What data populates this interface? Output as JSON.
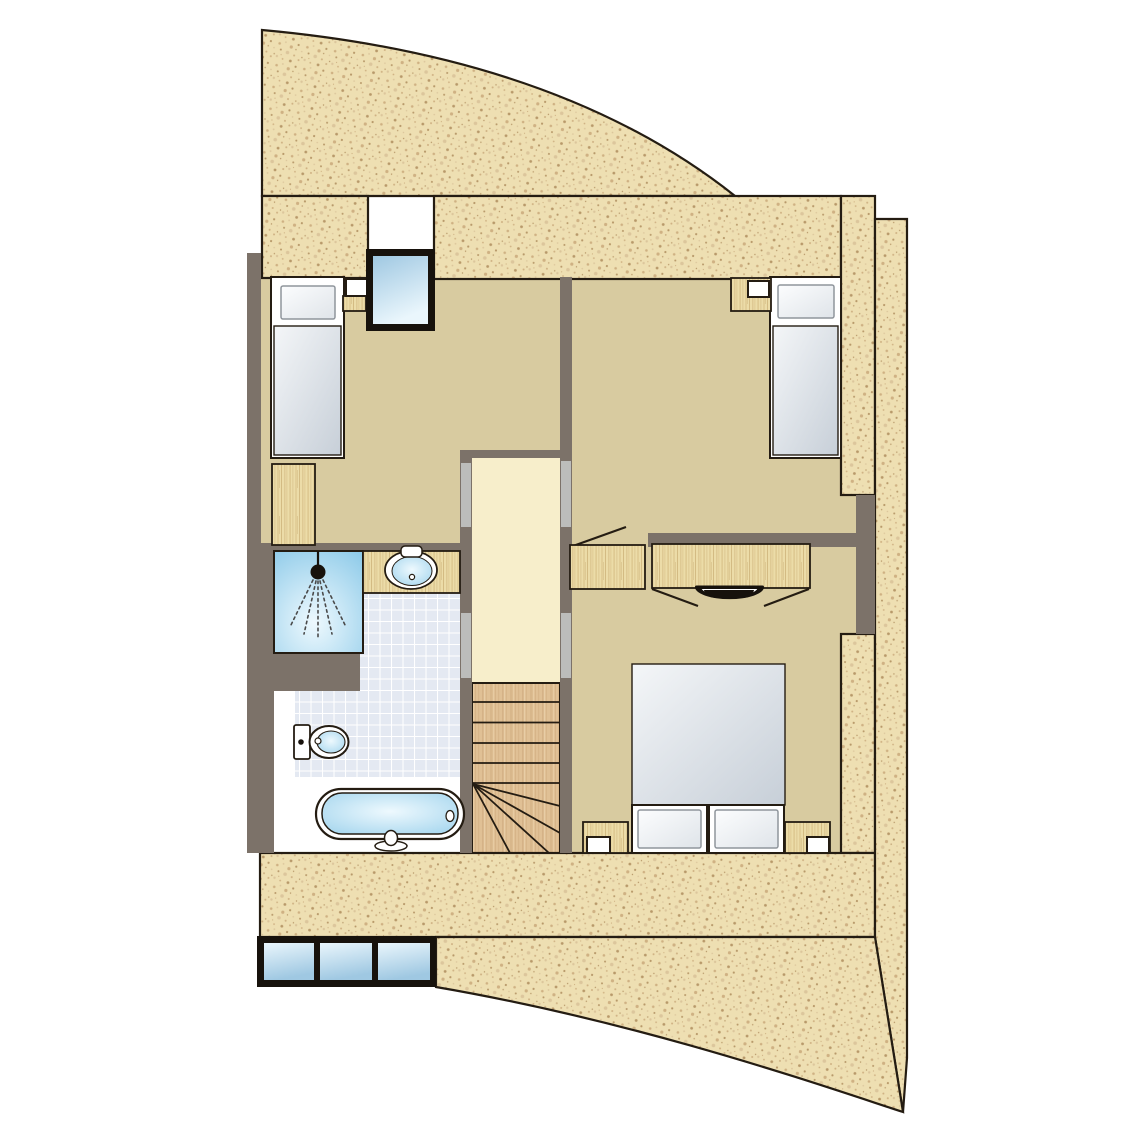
{
  "plan": {
    "type": "architectural-floor-plan",
    "rooms": [
      {
        "id": "bedroom-top-left",
        "kind": "bedroom",
        "furniture": [
          "single-bed",
          "nightstand",
          "dresser"
        ]
      },
      {
        "id": "bedroom-top-right",
        "kind": "bedroom",
        "furniture": [
          "single-bed",
          "nightstand"
        ]
      },
      {
        "id": "bedroom-bottom-right",
        "kind": "bedroom",
        "furniture": [
          "double-bed",
          "nightstand-left",
          "nightstand-right",
          "wardrobe",
          "dressing-table",
          "stool"
        ]
      },
      {
        "id": "bathroom",
        "kind": "bathroom",
        "fixtures": [
          "shower",
          "washbasin",
          "toilet",
          "bathtub"
        ]
      },
      {
        "id": "landing",
        "kind": "hall",
        "features": [
          "staircase"
        ]
      }
    ],
    "windows": [
      {
        "id": "skylight-top",
        "panes": 1
      },
      {
        "id": "skylight-bottom-row",
        "panes": 3
      }
    ],
    "doors": [
      {
        "from": "landing",
        "to": "bedroom-top-left"
      },
      {
        "from": "landing",
        "to": "bedroom-top-right"
      },
      {
        "from": "landing",
        "to": "bathroom"
      },
      {
        "from": "landing",
        "to": "bedroom-bottom-right"
      },
      {
        "from": "bedroom-top-right",
        "to": "bedroom-bottom-right",
        "swing_shown": true
      }
    ],
    "stairs": {
      "straight_treads": 5,
      "winder_treads": 4,
      "direction": "down-from-landing"
    }
  },
  "colors": {
    "sand_base": "#eedfb2",
    "sand_speck_dark": "#b8996a",
    "sand_speck_mid": "#cfb183",
    "sand_speck_light": "#dcc69c",
    "outline": "#241c12",
    "wall": "#7c7269",
    "door_jamb": "#bcbdbb",
    "floor": "#d8cba0",
    "landing": "#f7eecb",
    "bath_floor": "#ffffff",
    "wood_base": "#ecdca8",
    "wood_grain_a": "#d8bf87",
    "wood_grain_b": "#c9ad74",
    "stair_base": "#e0c095",
    "stair_grain": "#c9a276",
    "stair_grain_light": "#edd6b0",
    "tile_base": "#e4e9f2",
    "tile_line": "#ffffff",
    "fix_deep": "#8fcbe9",
    "fix_light": "#eef9fe",
    "glass_deep": "#9fc8e2",
    "glass_light": "#eaf6fc",
    "mattress_light": "#f4f6f8",
    "mattress_deep": "#c7cfd8",
    "pillow_light": "#fcfdfe",
    "pillow_deep": "#dfe4e9",
    "pillow_edge": "#8f959c",
    "spray": "#4a4a4a",
    "black": "#17120c",
    "white": "#ffffff"
  }
}
